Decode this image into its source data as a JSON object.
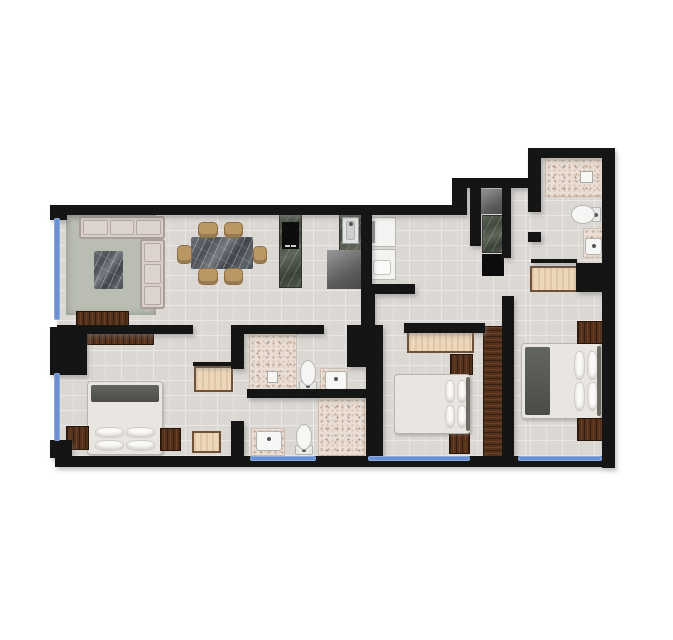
{
  "canvas": {
    "width": 673,
    "height": 640,
    "background": "#ffffff"
  },
  "palette": {
    "wall": "#151515",
    "window_glass": "#6a91d4",
    "tile": "#dbd7d3",
    "grout": "#eae7e4",
    "bath_speckle": "#eadfd7",
    "rug": "#b9bdb2",
    "upholstery": "#d9cec8",
    "chair_wood": "#bb9766",
    "marble_dark": "#4b5157",
    "marble_green": "#434a3e",
    "wood_dark": "#53311c",
    "wood_light": "#ecd7ba",
    "appliance_white": "#f3f3f1",
    "fixture_white": "#f6f6f4"
  },
  "plan": {
    "rooms": [
      {
        "name": "room-living-dining",
        "rect": [
          60,
          215,
          300,
          110
        ]
      },
      {
        "name": "room-kitchen",
        "rect": [
          275,
          213,
          140,
          80
        ]
      },
      {
        "name": "room-hallway",
        "rect": [
          230,
          295,
          270,
          30
        ]
      },
      {
        "name": "room-pantry",
        "rect": [
          480,
          188,
          27,
          90
        ]
      },
      {
        "name": "room-entry-corridor",
        "rect": [
          511,
          188,
          17,
          100
        ]
      },
      {
        "name": "room-bathroom-top-right",
        "rect": [
          541,
          158,
          62,
          100
        ]
      },
      {
        "name": "room-master-bedroom",
        "rect": [
          60,
          333,
          175,
          122
        ]
      },
      {
        "name": "room-bathroom-upper-middle",
        "rect": [
          248,
          333,
          100,
          58
        ]
      },
      {
        "name": "room-bathroom-lower-middle",
        "rect": [
          248,
          397,
          115,
          58
        ]
      },
      {
        "name": "room-bedroom-middle",
        "rect": [
          383,
          333,
          118,
          124
        ]
      },
      {
        "name": "room-bedroom-right",
        "rect": [
          513,
          296,
          89,
          160
        ]
      }
    ],
    "floors": [
      {
        "kind": "tile",
        "rect": [
          57,
          215,
          404,
          241
        ]
      },
      {
        "kind": "tile",
        "rect": [
          461,
          188,
          69,
          268
        ]
      },
      {
        "kind": "tile",
        "rect": [
          530,
          158,
          74,
          298
        ]
      },
      {
        "kind": "speckle",
        "rect": [
          545,
          157,
          58,
          40
        ]
      },
      {
        "kind": "speckle",
        "rect": [
          583,
          228,
          21,
          30
        ]
      },
      {
        "kind": "speckle",
        "rect": [
          249,
          333,
          48,
          57
        ]
      },
      {
        "kind": "speckle",
        "rect": [
          320,
          368,
          28,
          24
        ]
      },
      {
        "kind": "speckle",
        "rect": [
          318,
          397,
          47,
          59
        ]
      },
      {
        "kind": "speckle",
        "rect": [
          251,
          428,
          34,
          28
        ]
      }
    ],
    "walls": [
      [
        50,
        205,
        17,
        15
      ],
      [
        55,
        205,
        406,
        10
      ],
      [
        452,
        178,
        15,
        37
      ],
      [
        461,
        178,
        79,
        10
      ],
      [
        528,
        148,
        13,
        64
      ],
      [
        528,
        232,
        13,
        10
      ],
      [
        528,
        148,
        86,
        10
      ],
      [
        602,
        148,
        13,
        320
      ],
      [
        55,
        456,
        549,
        11
      ],
      [
        50,
        440,
        22,
        18
      ],
      [
        50,
        327,
        37,
        48
      ],
      [
        57,
        325,
        136,
        9
      ],
      [
        231,
        325,
        13,
        44
      ],
      [
        231,
        421,
        13,
        37
      ],
      [
        242,
        325,
        82,
        9
      ],
      [
        347,
        325,
        29,
        42
      ],
      [
        247,
        389,
        122,
        9
      ],
      [
        361,
        213,
        11,
        82
      ],
      [
        361,
        293,
        14,
        34
      ],
      [
        361,
        284,
        54,
        10
      ],
      [
        366,
        325,
        17,
        133
      ],
      [
        404,
        323,
        81,
        10
      ],
      [
        502,
        296,
        12,
        162
      ],
      [
        470,
        178,
        11,
        68
      ],
      [
        502,
        186,
        9,
        72
      ],
      [
        576,
        263,
        28,
        29
      ],
      [
        531,
        259,
        46,
        4
      ],
      [
        193,
        362,
        39,
        4
      ]
    ],
    "windows": [
      [
        54,
        218,
        6,
        102
      ],
      [
        54,
        373,
        6,
        68
      ],
      [
        250,
        456,
        66,
        5
      ],
      [
        368,
        456,
        102,
        5
      ],
      [
        518,
        456,
        84,
        5
      ]
    ],
    "furniture": [
      {
        "name": "living-rug",
        "kind": "rug",
        "rect": [
          66,
          215,
          90,
          100
        ]
      },
      {
        "name": "sofa-main",
        "kind": "sofa",
        "dir": "h",
        "cushions": 3,
        "rect": [
          79,
          216,
          86,
          23
        ]
      },
      {
        "name": "sofa-chaise",
        "kind": "sofa",
        "dir": "v",
        "cushions": 3,
        "rect": [
          140,
          239,
          25,
          70
        ]
      },
      {
        "name": "coffee-table",
        "kind": "marble-dark",
        "rect": [
          94,
          251,
          29,
          38
        ]
      },
      {
        "name": "tv-console",
        "kind": "wood-dark",
        "rect": [
          77,
          312,
          51,
          13
        ]
      },
      {
        "name": "tv-shelf",
        "kind": "wood-dark",
        "rect": [
          87,
          333,
          66,
          11
        ]
      },
      {
        "name": "dining-table",
        "kind": "marble-dark",
        "rect": [
          191,
          237,
          62,
          32
        ]
      },
      {
        "name": "dining-chair-1",
        "kind": "chair",
        "rect": [
          198,
          222,
          20,
          16
        ]
      },
      {
        "name": "dining-chair-2",
        "kind": "chair",
        "rect": [
          224,
          222,
          19,
          16
        ]
      },
      {
        "name": "dining-chair-3",
        "kind": "chair",
        "rect": [
          198,
          268,
          20,
          17
        ]
      },
      {
        "name": "dining-chair-4",
        "kind": "chair",
        "rect": [
          224,
          268,
          19,
          17
        ]
      },
      {
        "name": "dining-chair-5",
        "kind": "chair",
        "rect": [
          177,
          245,
          15,
          19
        ]
      },
      {
        "name": "dining-chair-6",
        "kind": "chair",
        "rect": [
          253,
          246,
          14,
          18
        ]
      },
      {
        "name": "kitchen-counter-cooktop",
        "kind": "marble-green",
        "rect": [
          279,
          214,
          23,
          74
        ]
      },
      {
        "name": "cooktop",
        "kind": "cooktop",
        "rect": [
          282,
          222,
          17,
          27
        ]
      },
      {
        "name": "kitchen-counter-sink",
        "kind": "marble-green",
        "rect": [
          339,
          209,
          23,
          75
        ]
      },
      {
        "name": "kitchen-sink",
        "kind": "steel-sink",
        "rect": [
          342,
          217,
          17,
          27
        ]
      },
      {
        "name": "kitchen-island",
        "kind": "gray-box",
        "rect": [
          327,
          250,
          38,
          39
        ]
      },
      {
        "name": "refrigerator",
        "kind": "fridge",
        "rect": [
          368,
          217,
          28,
          30
        ]
      },
      {
        "name": "washer",
        "kind": "washer",
        "rect": [
          368,
          249,
          28,
          31
        ]
      },
      {
        "name": "pantry-unit-top",
        "kind": "gray-box",
        "rect": [
          481,
          189,
          25,
          25
        ]
      },
      {
        "name": "pantry-counter",
        "kind": "marble-green",
        "rect": [
          482,
          215,
          21,
          38
        ]
      },
      {
        "name": "pantry-unit-bottom",
        "kind": "black-box",
        "rect": [
          482,
          254,
          22,
          22
        ]
      },
      {
        "name": "toilet-bath-top-right",
        "kind": "toilet",
        "orient": "left",
        "rect": [
          571,
          205,
          30,
          19
        ]
      },
      {
        "name": "sink-bath-top-right",
        "kind": "sink",
        "rect": [
          585,
          238,
          17,
          17
        ]
      },
      {
        "name": "shower-fixture-top-right",
        "kind": "fixture",
        "rect": [
          580,
          171,
          13,
          12
        ]
      },
      {
        "name": "desk-bedroom-right",
        "kind": "wood-light",
        "rect": [
          530,
          266,
          48,
          26
        ]
      },
      {
        "name": "wardrobe-bedroom-right",
        "kind": "wood-dark-v",
        "rect": [
          484,
          327,
          19,
          130
        ]
      },
      {
        "name": "bed-bedroom-right",
        "kind": "bed",
        "pillows": "right",
        "blanket": "left",
        "headboard": "right",
        "rect": [
          521,
          343,
          81,
          76
        ]
      },
      {
        "name": "nightstand-right-top",
        "kind": "wood-dark",
        "rect": [
          578,
          322,
          24,
          21
        ]
      },
      {
        "name": "nightstand-right-bottom",
        "kind": "wood-dark",
        "rect": [
          578,
          419,
          24,
          21
        ]
      },
      {
        "name": "desk-bedroom-middle",
        "kind": "wood-light",
        "rect": [
          407,
          330,
          67,
          23
        ]
      },
      {
        "name": "nightstand-middle-top",
        "kind": "wood-dark",
        "rect": [
          451,
          355,
          21,
          19
        ]
      },
      {
        "name": "nightstand-middle-bottom",
        "kind": "wood-dark",
        "rect": [
          450,
          433,
          19,
          20
        ]
      },
      {
        "name": "bed-bedroom-middle",
        "kind": "bed",
        "pillows": "right",
        "blanket": null,
        "headboard": "right",
        "rect": [
          394,
          374,
          77,
          60
        ]
      },
      {
        "name": "wardrobe-bedroom-middle",
        "kind": "wood-dark-v",
        "rect": [
          368,
          370,
          14,
          87
        ]
      },
      {
        "name": "bed-master",
        "kind": "bed",
        "pillows": "bottom",
        "blanket": "top",
        "headboard": null,
        "rect": [
          87,
          381,
          76,
          74
        ]
      },
      {
        "name": "nightstand-master-left",
        "kind": "wood-dark",
        "rect": [
          67,
          427,
          21,
          22
        ]
      },
      {
        "name": "nightstand-master-right",
        "kind": "wood-dark",
        "rect": [
          161,
          429,
          19,
          21
        ]
      },
      {
        "name": "dresser-master",
        "kind": "wood-light",
        "rect": [
          194,
          366,
          39,
          26
        ]
      },
      {
        "name": "side-table-master",
        "kind": "wood-light",
        "rect": [
          192,
          431,
          29,
          22
        ]
      },
      {
        "name": "toilet-bath-upper",
        "kind": "toilet",
        "orient": "up",
        "rect": [
          298,
          360,
          20,
          31
        ]
      },
      {
        "name": "sink-bath-upper",
        "kind": "sink",
        "rect": [
          325,
          371,
          22,
          19
        ]
      },
      {
        "name": "shower-fixture-upper",
        "kind": "fixture",
        "rect": [
          267,
          371,
          11,
          12
        ]
      },
      {
        "name": "toilet-bath-lower",
        "kind": "toilet",
        "orient": "up",
        "rect": [
          294,
          424,
          20,
          31
        ]
      },
      {
        "name": "sink-bath-lower",
        "kind": "sink",
        "rect": [
          256,
          431,
          26,
          20
        ]
      }
    ]
  }
}
